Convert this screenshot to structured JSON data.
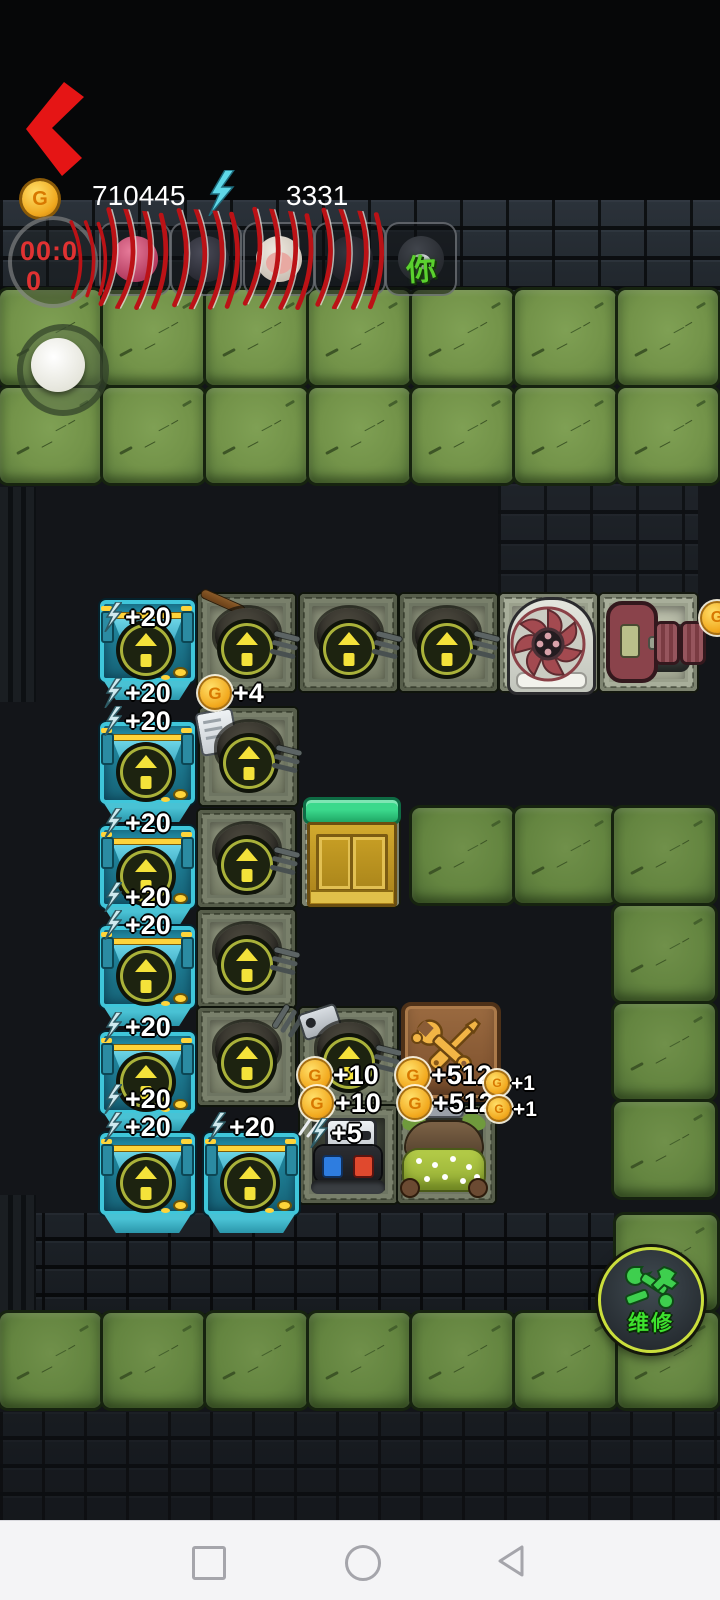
{
  "hud": {
    "coin_value": "710445",
    "energy_value": "3331",
    "timer_line1": "00:0",
    "timer_line2": "0",
    "slot_tag": "你"
  },
  "icons": {
    "coin_letter": "G"
  },
  "board": {
    "floating_labels": [
      {
        "icon": "bolt",
        "text": "+20",
        "x": 104,
        "y": 602,
        "size": "md"
      },
      {
        "icon": "bolt",
        "text": "+20",
        "x": 104,
        "y": 678,
        "size": "md"
      },
      {
        "icon": "bolt",
        "text": "+20",
        "x": 104,
        "y": 706,
        "size": "md"
      },
      {
        "icon": "bolt",
        "text": "+20",
        "x": 104,
        "y": 808,
        "size": "md"
      },
      {
        "icon": "bolt",
        "text": "+20",
        "x": 104,
        "y": 882,
        "size": "md"
      },
      {
        "icon": "bolt",
        "text": "+20",
        "x": 104,
        "y": 910,
        "size": "md"
      },
      {
        "icon": "bolt",
        "text": "+20",
        "x": 104,
        "y": 1012,
        "size": "md"
      },
      {
        "icon": "bolt",
        "text": "+20",
        "x": 104,
        "y": 1084,
        "size": "md"
      },
      {
        "icon": "bolt",
        "text": "+20",
        "x": 104,
        "y": 1112,
        "size": "md"
      },
      {
        "icon": "bolt",
        "text": "+20",
        "x": 208,
        "y": 1112,
        "size": "md"
      },
      {
        "icon": "coin",
        "text": "+4",
        "x": 200,
        "y": 678,
        "size": "md"
      },
      {
        "icon": "coin",
        "text": "+10",
        "x": 300,
        "y": 1060,
        "size": "md"
      },
      {
        "icon": "coin",
        "text": "+10",
        "x": 302,
        "y": 1088,
        "size": "md"
      },
      {
        "icon": "bolt",
        "text": "+5",
        "x": 310,
        "y": 1118,
        "size": "md"
      },
      {
        "icon": "coin",
        "text": "+512",
        "x": 398,
        "y": 1060,
        "size": "md"
      },
      {
        "icon": "coin",
        "text": "+512",
        "x": 400,
        "y": 1088,
        "size": "md"
      },
      {
        "icon": "coin",
        "text": "+1",
        "x": 486,
        "y": 1072,
        "size": "sm"
      },
      {
        "icon": "coin",
        "text": "+1",
        "x": 488,
        "y": 1098,
        "size": "sm"
      }
    ]
  },
  "repair_button": {
    "label": "维修"
  },
  "colors": {
    "accent_red": "#e51515",
    "coin_gold": "#f2a81d",
    "energy_cyan": "#5fd8e8",
    "grass_green": "#739349",
    "repair_green": "#3ee22e",
    "door_health_green": "#2eb873"
  }
}
